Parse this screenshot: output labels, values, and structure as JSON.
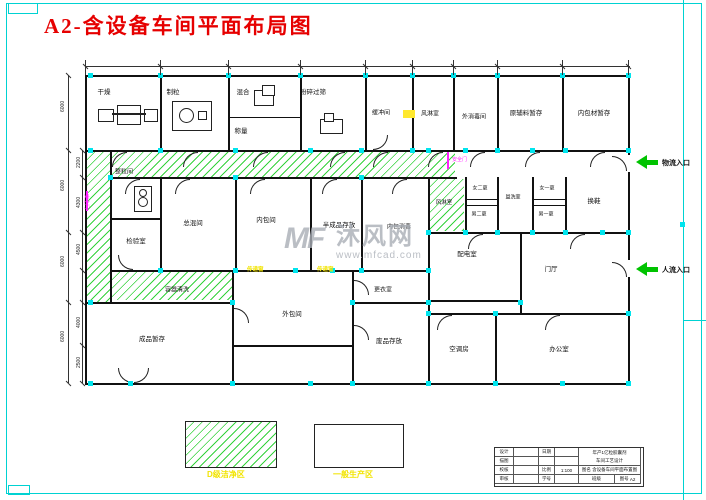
{
  "title": "A2-含设备车间平面布局图",
  "watermark": {
    "logo": "MF",
    "brand": "沐风网",
    "url": "www.mfcad.com"
  },
  "rooms": [
    {
      "label": "干燥"
    },
    {
      "label": "制粒"
    },
    {
      "label": "混合"
    },
    {
      "label": "称量"
    },
    {
      "label": "粉碎过筛"
    },
    {
      "label": "缓冲间"
    },
    {
      "label": "风淋室"
    },
    {
      "label": "外消毒间"
    },
    {
      "label": "原辅料暂存"
    },
    {
      "label": "内包材暂存"
    },
    {
      "label": "整粒间"
    },
    {
      "label": "检验室"
    },
    {
      "label": "总混间"
    },
    {
      "label": "内包间"
    },
    {
      "label": "半成品存放"
    },
    {
      "label": "内包消毒"
    },
    {
      "label": "风淋室"
    },
    {
      "label": "女二更"
    },
    {
      "label": "男二更"
    },
    {
      "label": "盥洗室"
    },
    {
      "label": "女一更"
    },
    {
      "label": "男一更"
    },
    {
      "label": "换鞋"
    },
    {
      "label": "配电室"
    },
    {
      "label": "门厅"
    },
    {
      "label": "容器清洗"
    },
    {
      "label": "成品暂存"
    },
    {
      "label": "外包间"
    },
    {
      "label": "更衣室"
    },
    {
      "label": "废品存放"
    },
    {
      "label": "空调房"
    },
    {
      "label": "办公室"
    }
  ],
  "entrances": [
    {
      "label": "物流入口"
    },
    {
      "label": "人流入口"
    }
  ],
  "safety_doors": [
    "安全门",
    "安全门"
  ],
  "transfer_windows": [
    "传递窗",
    "传递窗"
  ],
  "legend": [
    {
      "label": "D级洁净区"
    },
    {
      "label": "一般生产区"
    }
  ],
  "dimensions": {
    "left_outer": [
      "6000",
      "6000",
      "6000",
      "6000"
    ],
    "left_inner": [
      "2200",
      "4300",
      "4500",
      "4000",
      "2500"
    ]
  },
  "title_block": {
    "r1a": "设计",
    "r1c": "日期",
    "r2a": "描图",
    "r3a": "校核",
    "r3c": "比例",
    "r3d": "1:100",
    "r4a": "审核",
    "r4c": "学号",
    "r4e": "班级",
    "r4g": "图号",
    "r4h": "A2",
    "project1": "年产1亿粒胶囊剂",
    "project2": "车间工艺设计",
    "name_label": "图名",
    "name": "含设备车间平面布置图"
  }
}
